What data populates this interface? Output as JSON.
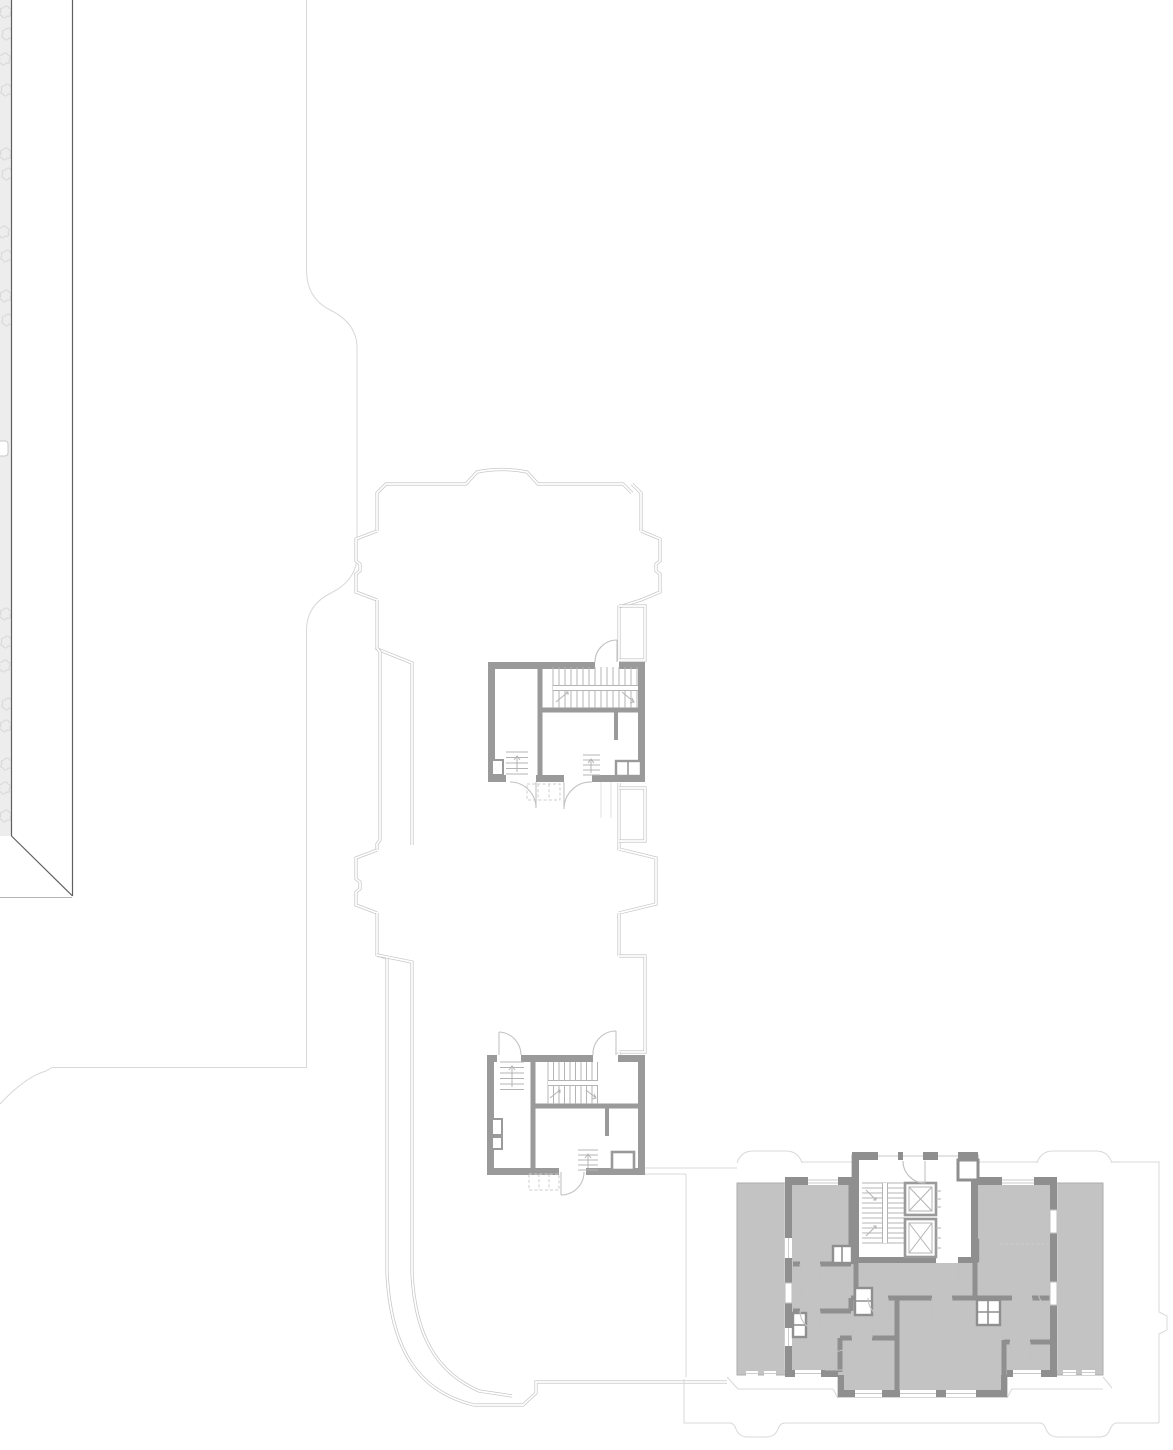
{
  "document": {
    "title": "Architectural site plan — residential wing with stair cores and apartment block"
  },
  "colors": {
    "paper": "#ffffff",
    "dark_line": "#5f5f5f",
    "site_line": "#d8d8d8",
    "shell_line": "#c8c8c8",
    "core_wall": "#9a9a9a",
    "apt_wall": "#8f8f8f",
    "floor_fill": "#c3c3c3",
    "plate_edge": "#aeaeae",
    "detail": "#b4b4b4",
    "arc_line": "#c2c2c2",
    "dash_line": "#cccccc",
    "hatch_bg": "#ededed",
    "hatch_fg": "#d7d7d7",
    "faint_line": "#e2e2e2"
  }
}
